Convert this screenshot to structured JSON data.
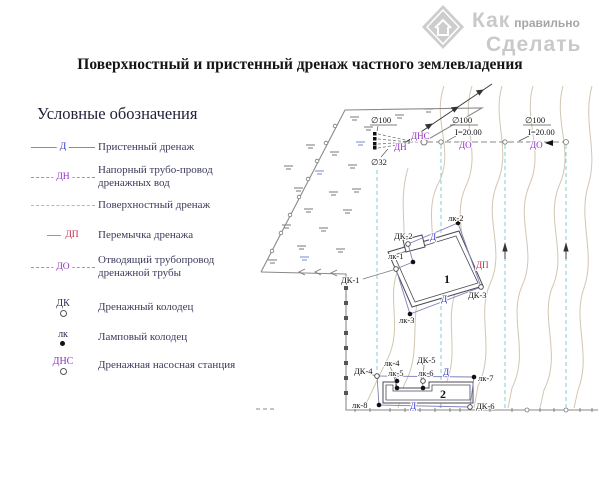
{
  "watermark": {
    "word1": "Как",
    "word2": "правильно",
    "word3": "Сделать"
  },
  "title": "Поверхностный и пристенный дренаж частного землевладения",
  "legend": {
    "heading": "Условные обозначения",
    "items": [
      {
        "symbol": "Д",
        "label": "Пристенный дренаж",
        "type": "solid-line"
      },
      {
        "symbol": "ДН",
        "label": "Напорный трубо-провод дренажных вод",
        "type": "dashed-line"
      },
      {
        "symbol": "",
        "label": "Поверхностный дренаж",
        "type": "cyan-dashed-line"
      },
      {
        "symbol": "ДП",
        "label": "Перемычка дренажа",
        "type": "short-line"
      },
      {
        "symbol": "ДО",
        "label": "Отводящий трубопровод дренажной трубы",
        "type": "dashed-line"
      },
      {
        "symbol": "ДК",
        "label": "Дренажный колодец",
        "type": "open-circle"
      },
      {
        "symbol": "лк",
        "label": "Ламповый колодец",
        "type": "filled-dot"
      },
      {
        "symbol": "ДНС",
        "label": "Дренажная насосная станция",
        "type": "open-circle"
      }
    ]
  },
  "plan": {
    "buildings": {
      "b1": "1",
      "b2": "2"
    },
    "pipes": {
      "d100": "∅100",
      "d32": "∅32",
      "slope": "I=20.00"
    },
    "lines": {
      "d": "Д",
      "dn": "ДН",
      "dns": "ДНС",
      "do": "ДО",
      "dp": "ДП"
    },
    "wells": {
      "dk1": "ДК-1",
      "dk2": "ДК-2",
      "dk3": "ДК-3",
      "dk4": "ДК-4",
      "dk5": "ДК-5",
      "dk6": "ДК-6",
      "lk1": "лк-1",
      "lk2": "лк-2",
      "lk3": "лк-3",
      "lk4": "лк-4",
      "lk5": "лк-5",
      "lk6": "лк-6",
      "lk7": "лк-7",
      "lk8": "лк-8"
    }
  },
  "colors": {
    "blue_label": "#2f2fd0",
    "purple_label": "#8f2fbf",
    "red_label": "#c02848",
    "cyan_line": "#7fcfcf",
    "contour": "#d2c6b2",
    "legend_text": "#3a3a5c"
  }
}
